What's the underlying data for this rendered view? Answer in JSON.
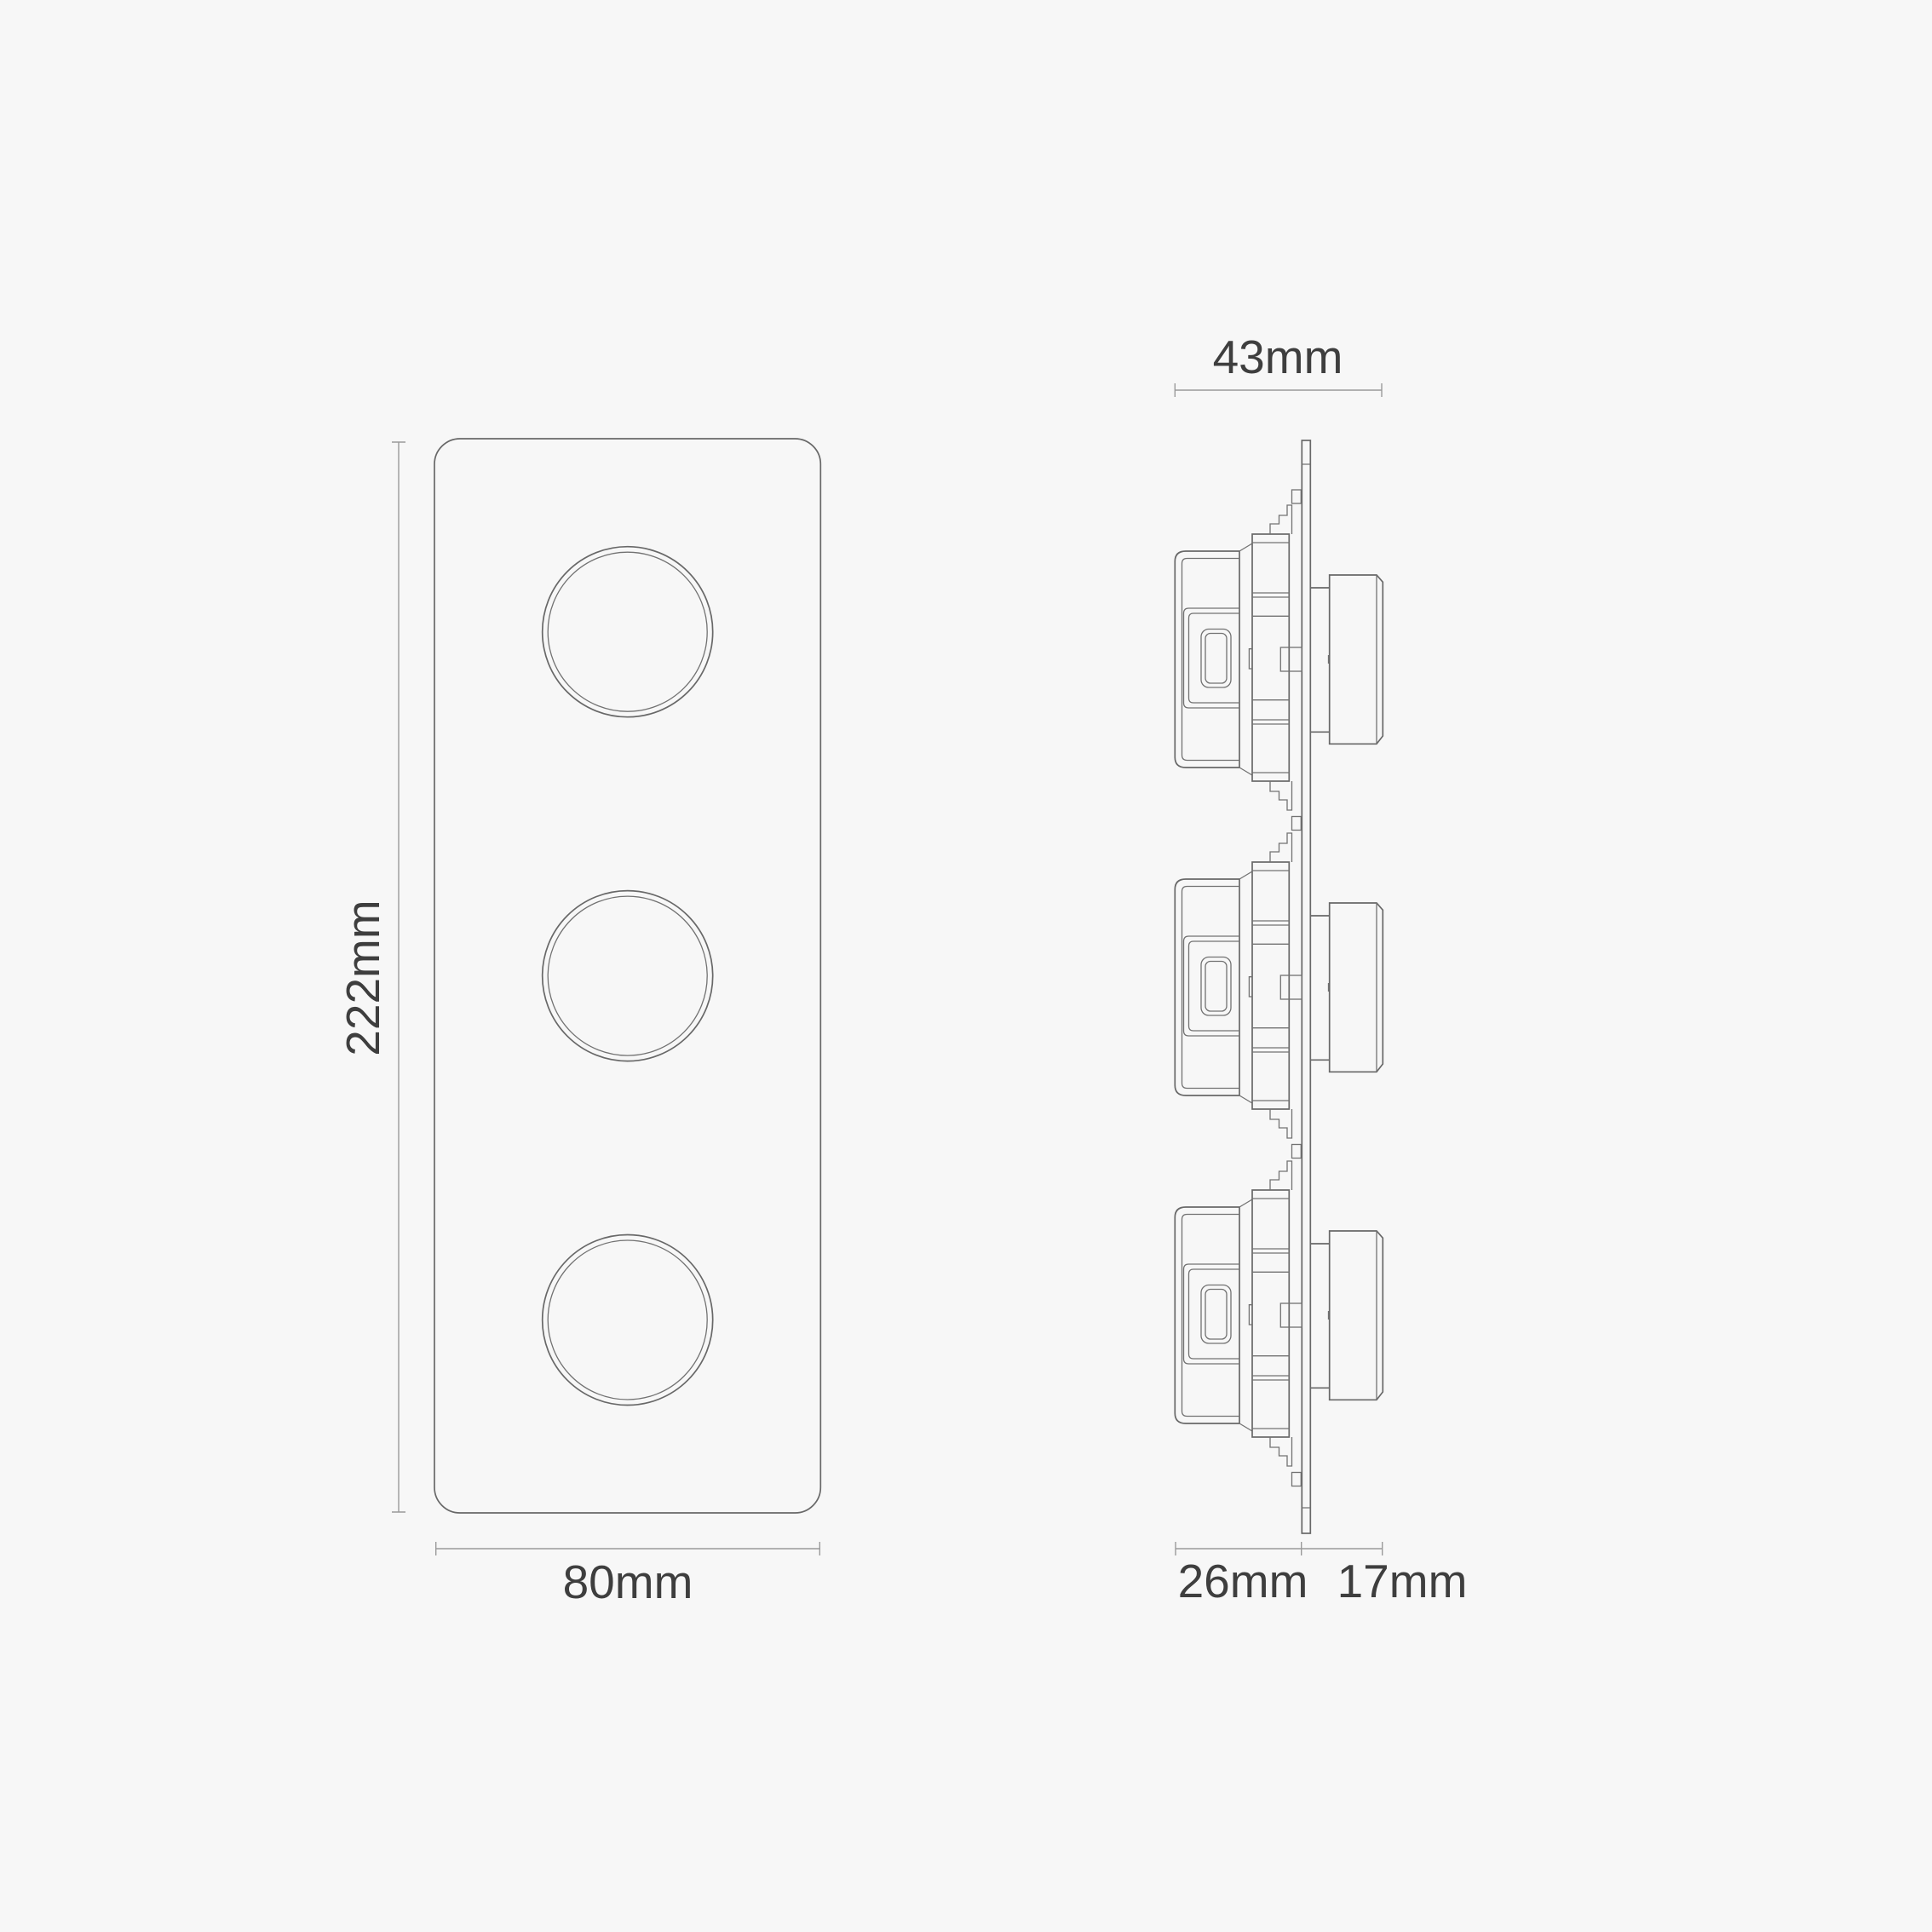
{
  "canvas": {
    "background": "#f7f7f7"
  },
  "palette": {
    "outline_line": "#686868",
    "detail_line": "#727272",
    "dimension_line": "#9a9a9a",
    "label_text": "#3e3e3e"
  },
  "front_view": {
    "knob_count": 3,
    "labels": {
      "height": "222mm",
      "width": "80mm"
    }
  },
  "side_view": {
    "module_count": 3,
    "labels": {
      "overall_depth": "43mm",
      "depth_behind_plate": "26mm",
      "depth_in_front": "17mm"
    }
  }
}
